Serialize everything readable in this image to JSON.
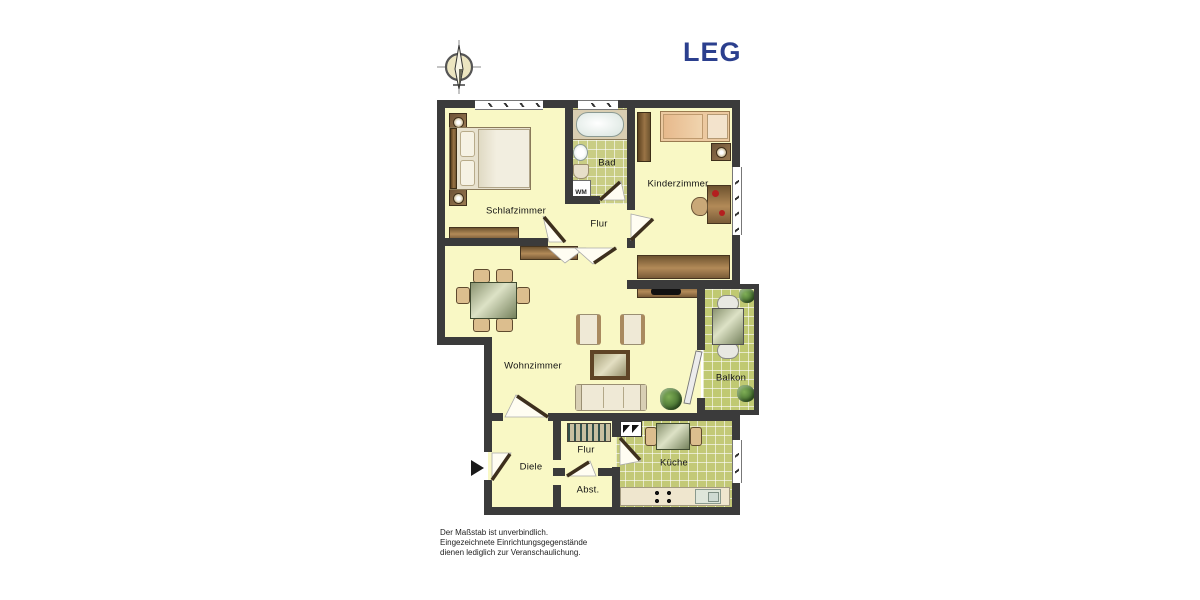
{
  "header": {
    "logo_text": "LEG",
    "logo_color": "#2b3f8e"
  },
  "compass": {
    "icon": "north-arrow"
  },
  "rooms": {
    "schlafzimmer": "Schlafzimmer",
    "bad": "Bad",
    "kinderzimmer": "Kinderzimmer",
    "flur_oben": "Flur",
    "wohnzimmer": "Wohnzimmer",
    "balkon": "Balkon",
    "diele": "Diele",
    "flur_unten": "Flur",
    "abstellraum": "Abst.",
    "kueche": "Küche"
  },
  "appliances": {
    "waschmaschine": "WM"
  },
  "footer": {
    "line1": "Der Maßstab ist unverbindlich.",
    "line2": "Eingezeichnete Einrichtungsgegenstände",
    "line3": "dienen lediglich zur Veranschaulichung."
  },
  "colors": {
    "wall": "#3b3b3b",
    "room_floor": "#f9f8c5",
    "tile_floor": "#c6cb7e",
    "balcony_floor": "#c0c972",
    "logo_blue": "#2b3f8e"
  }
}
